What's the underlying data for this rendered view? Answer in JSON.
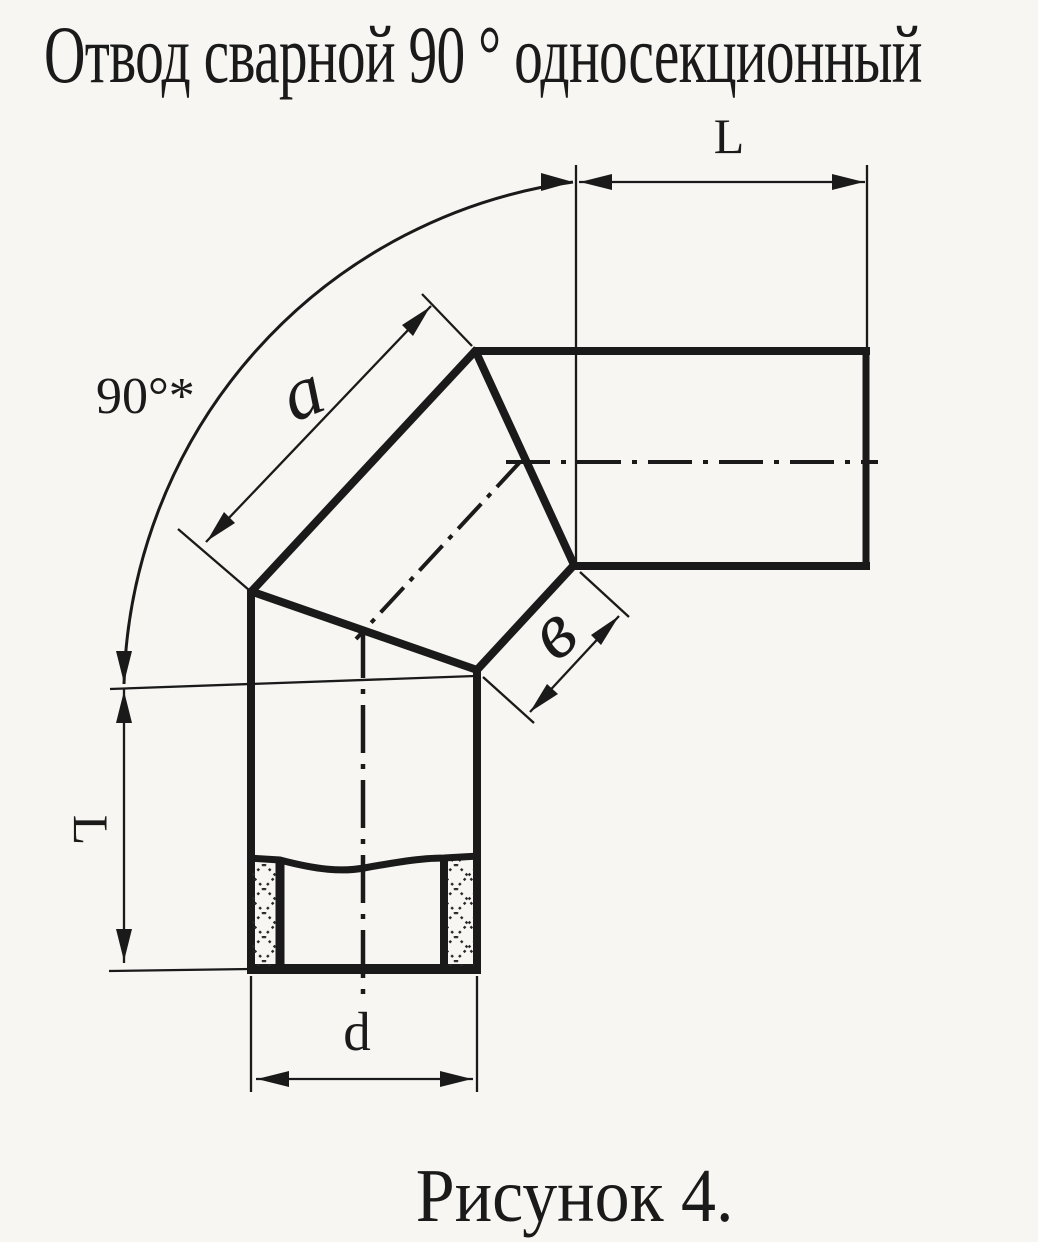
{
  "title": "Отвод сварной 90 ° односекционный",
  "caption": "Рисунок 4.",
  "dimension_labels": {
    "angle": "90°*",
    "length_top": "L",
    "length_left": "L",
    "section_outer_side": "a",
    "section_inner_side": "в",
    "diameter": "d"
  },
  "colors": {
    "ink": "#1a1a1a",
    "paper": "#f7f6f2"
  }
}
